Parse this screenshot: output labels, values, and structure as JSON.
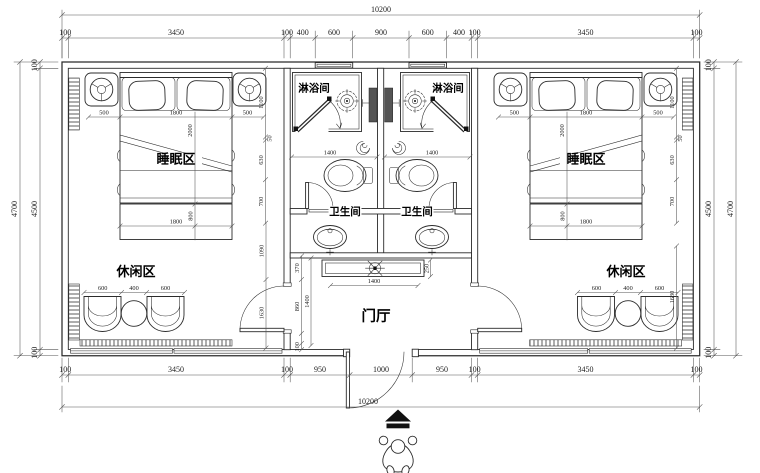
{
  "meta": {
    "drawing_type": "hotel twin-suite floor plan",
    "background": "#ffffff",
    "line_color": "#2b2b2b",
    "dark_fill": "#555555",
    "units": "mm"
  },
  "labels": {
    "shower": "淋浴间",
    "toilet": "卫生间",
    "sleep": "睡眠区",
    "leisure": "休闲区",
    "foyer": "门厅"
  },
  "dims": {
    "overall_width": "10200",
    "overall_height": "4700",
    "inner_height": "4500",
    "wall_thickness": "100",
    "top_row": [
      "100",
      "3450",
      "100",
      "400",
      "600",
      "900",
      "600",
      "400",
      "100",
      "3450",
      "100"
    ],
    "bottom_row": [
      "100",
      "3450",
      "100",
      "950",
      "1000",
      "950",
      "100",
      "3450",
      "100"
    ],
    "bed": {
      "side": "500",
      "width": "1800",
      "head_depth": "1100",
      "length": "2000",
      "foot_depth": "800"
    },
    "leisure": {
      "chair_width": "600",
      "table_width": "400"
    },
    "bath": {
      "width": "1400"
    },
    "foyer": {
      "console_width": "1400",
      "console_depth": "250",
      "depth": "1400",
      "left_offset": "370",
      "side": "860",
      "edge": "100"
    },
    "column": {
      "d50": "50",
      "d630": "630",
      "d700": "700",
      "d1090": "1090",
      "d1630": "1630"
    }
  }
}
